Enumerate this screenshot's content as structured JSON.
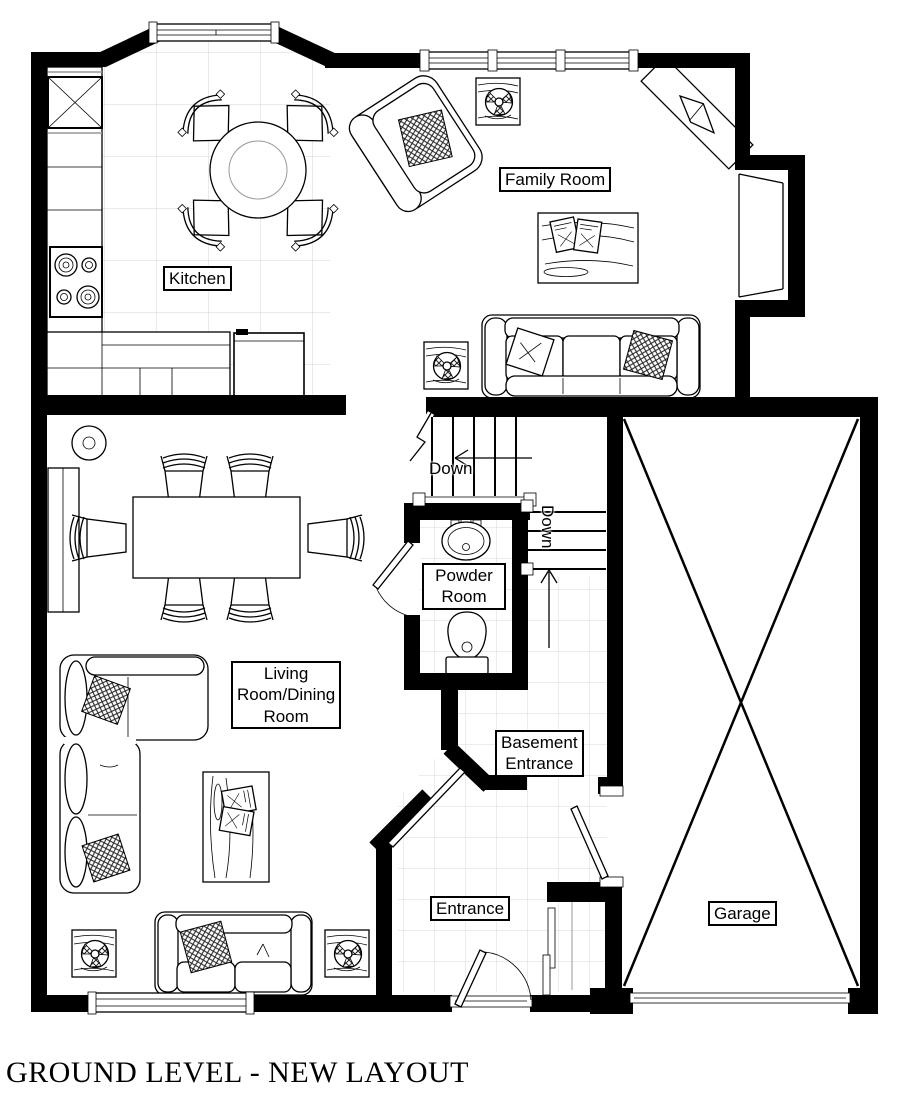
{
  "title": "GROUND LEVEL - NEW LAYOUT",
  "rooms": {
    "kitchen": {
      "label": "Kitchen"
    },
    "family_room": {
      "label": "Family Room"
    },
    "powder_room": {
      "label": "Powder\nRoom"
    },
    "living_dining": {
      "label": "Living\nRoom/Dining\nRoom"
    },
    "basement_entrance": {
      "label": "Basement\nEntrance"
    },
    "entrance": {
      "label": "Entrance"
    },
    "garage": {
      "label": "Garage"
    }
  },
  "stairs": {
    "upper_label": "Down",
    "lower_label": "Down"
  },
  "colors": {
    "wall": "#000000",
    "tile_line": "#d4d4d4",
    "background": "#ffffff"
  }
}
